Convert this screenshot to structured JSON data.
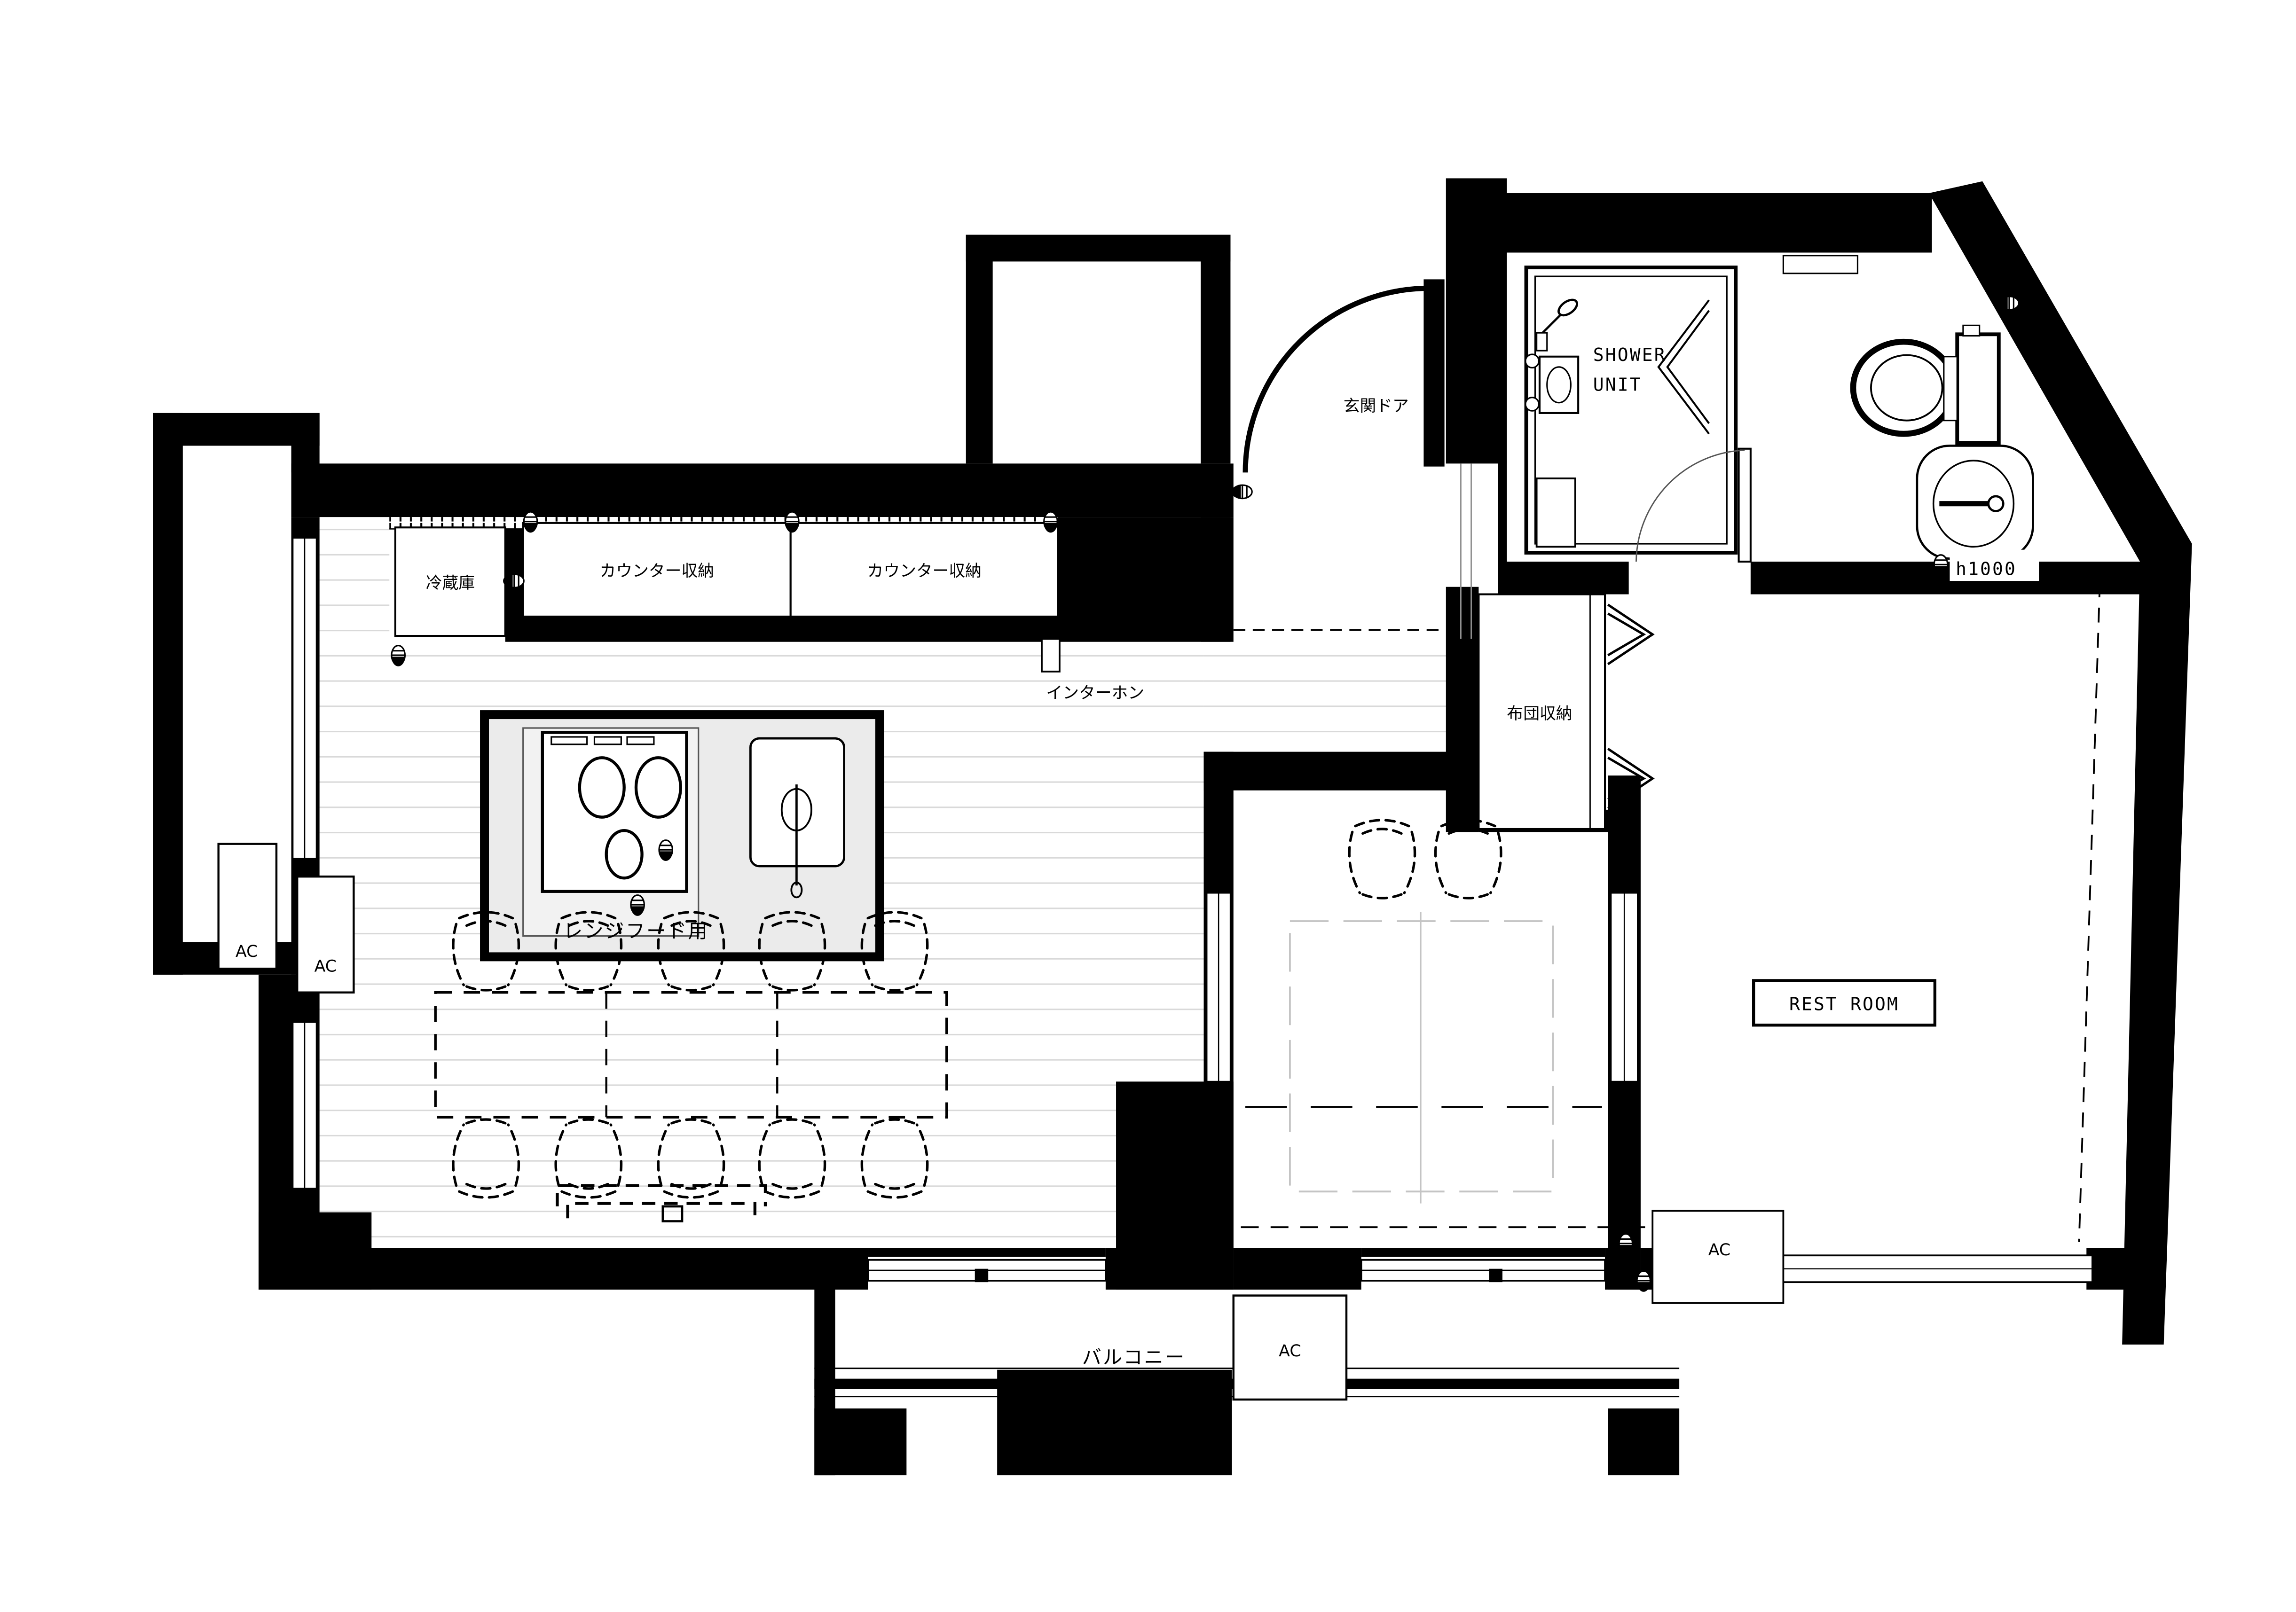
{
  "plan": {
    "type": "architectural floor plan",
    "labels": {
      "fridge": "冷蔵庫",
      "counter_storage_left": "カウンター収納",
      "counter_storage_right": "カウンター収納",
      "intercom": "インターホン",
      "range_hood": "レンジフード用",
      "entrance_door": "玄関ドア",
      "shower_line1": "SHOWER",
      "shower_line2": "UNIT",
      "futon_storage": "布団収納",
      "rest_room": "REST ROOM",
      "balcony": "バルコニー",
      "ac": "AC",
      "height_note": "h1000"
    },
    "colors": {
      "wall": "#000000",
      "floor_line": "#d9d9d9",
      "island_fill": "#ebebeb",
      "paper": "#ffffff"
    }
  }
}
